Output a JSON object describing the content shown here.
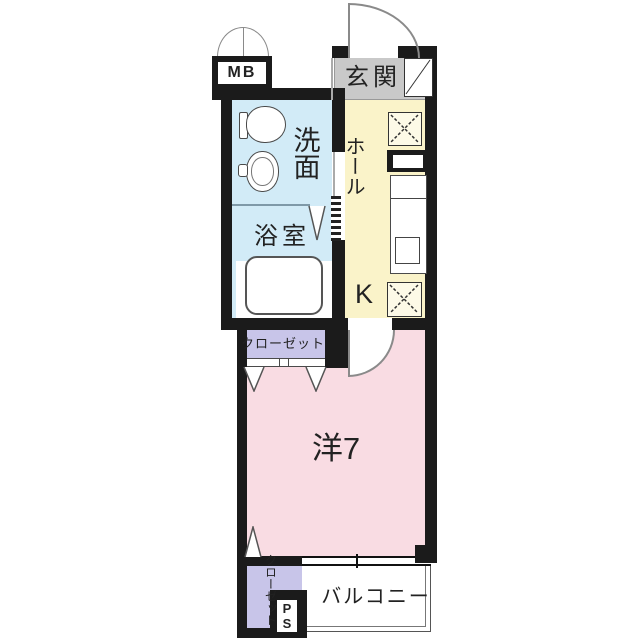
{
  "plan_title": "apartment floor plan",
  "colors": {
    "wall": "#1b1b1b",
    "wet": "#d2ebf7",
    "hall": "#faf3c9",
    "entrance": "#c9c9c9",
    "closet": "#c8c5e9",
    "room": "#f9dce3",
    "line": "#4a4a4a",
    "arc": "#8a8a8a",
    "text": "#222222"
  },
  "rooms": {
    "meter_box": {
      "label": "MB"
    },
    "entrance": {
      "label": "玄関"
    },
    "washroom": {
      "label": "洗面"
    },
    "hall": {
      "label": "ホール"
    },
    "kitchen": {
      "label": "K"
    },
    "bathroom": {
      "label": "浴室"
    },
    "closet_upper": {
      "label": "クローゼット"
    },
    "western_room": {
      "label": "洋7"
    },
    "closet_lower": {
      "label": "クローゼット"
    },
    "pipe_space": {
      "label": "PS"
    },
    "balcony": {
      "label": "バルコニー"
    }
  },
  "fixtures": [
    "toilet",
    "sink",
    "bathtub",
    "kitchen-counter",
    "counter-sink",
    "washer-pan-upper",
    "washer-pan-lower",
    "shoe-cabinet",
    "entry-door-swing",
    "meter-box-double-doors",
    "room-door-swing",
    "bathroom-folding-door",
    "closet-folding-doors",
    "window"
  ]
}
